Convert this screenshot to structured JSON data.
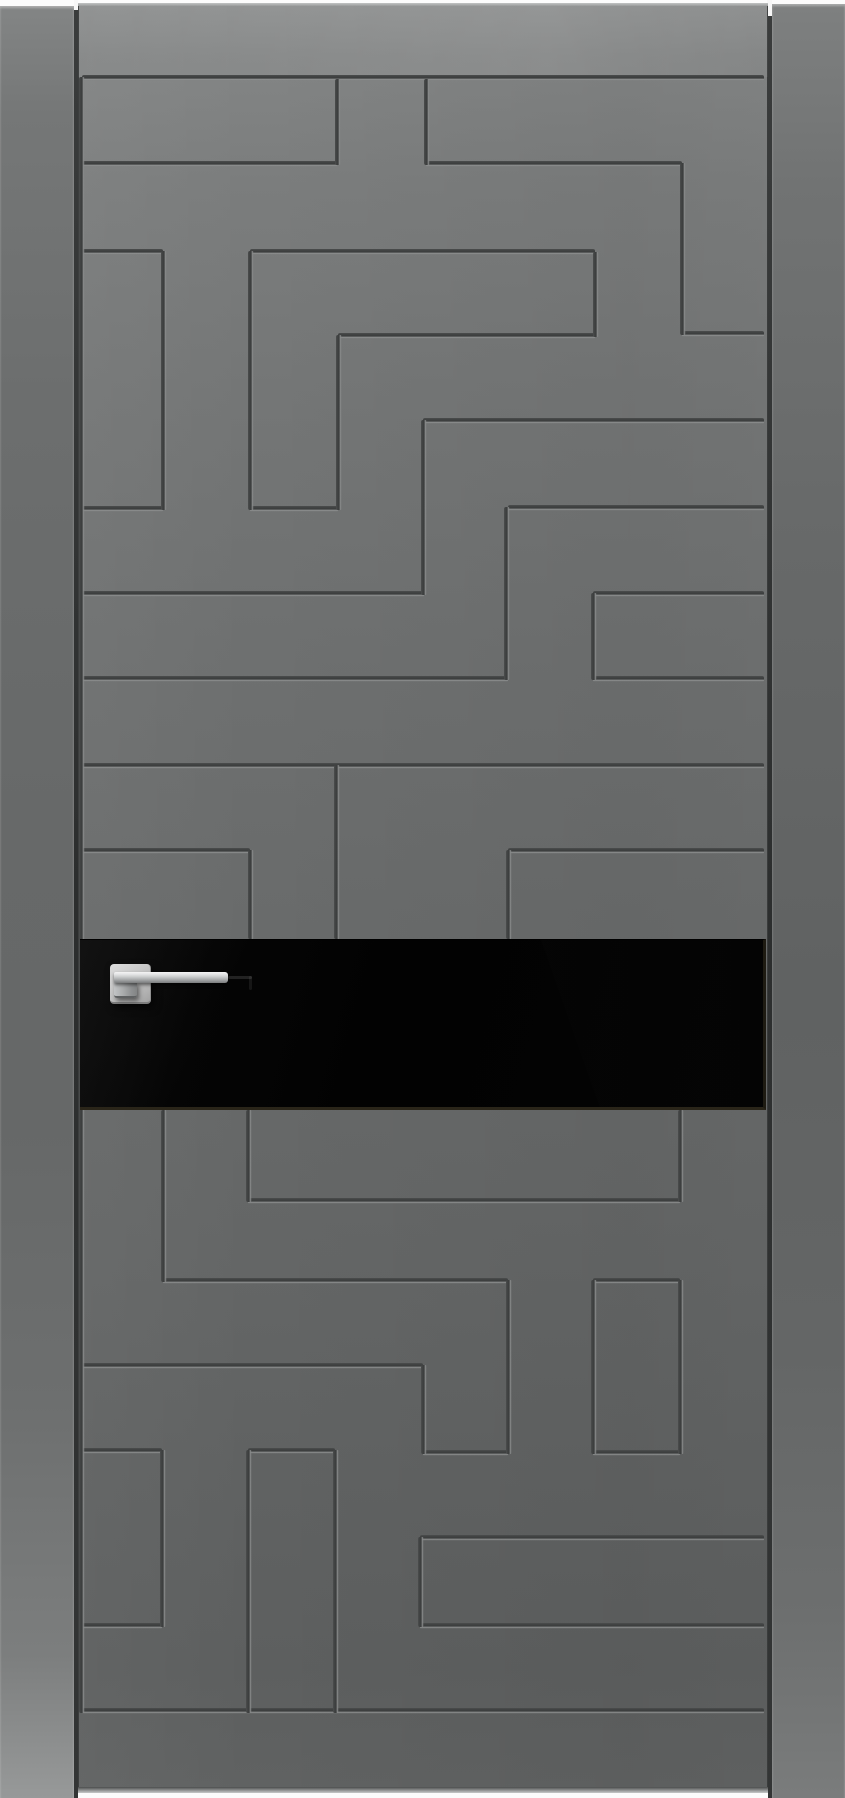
{
  "meta": {
    "description": "Product photograph of a modern grey interior door leaf with CNC-milled Greek-key maze pattern, horizontal black gloss glass insert and square-rosette chrome lever handle, shown between two frame jamb boards on a white background",
    "image_width": 845,
    "image_height": 1798
  },
  "palette": {
    "background": "#fcfcfc",
    "door_grey_light": "#8d8f8f",
    "door_grey_mid": "#6a6c6c",
    "door_grey_dark": "#5d5f5f",
    "groove_dark": "#3a3c3c",
    "groove_highlight": "#8f9191",
    "glass_black": "#020202",
    "glass_edge_tint": "#2a2519",
    "chrome_light": "#f4f4f4",
    "chrome_mid": "#c9cbcc",
    "chrome_dark": "#7b7d7e"
  },
  "door": {
    "frame": {
      "left_stile": {
        "x": 0,
        "y": 6,
        "w": 74,
        "h": 1792
      },
      "right_stile": {
        "x": 772,
        "y": 4,
        "w": 73,
        "h": 1794
      },
      "left_gap": {
        "x": 74,
        "y": 10,
        "w": 4,
        "h": 1788
      },
      "right_gap": {
        "x": 768,
        "y": 16,
        "w": 4,
        "h": 1782
      },
      "left_gap_notch": {
        "x": 74,
        "y": 0,
        "w": 4,
        "h": 10
      },
      "right_gap_notch": {
        "x": 767,
        "y": 0,
        "w": 5,
        "h": 16
      }
    },
    "slab": {
      "x": 78,
      "y": 3,
      "w": 690,
      "h": 1790
    },
    "edge_top": {
      "x": 78,
      "y": 3,
      "w": 690,
      "h": 3
    },
    "edge_bottom": {
      "x": 78,
      "y": 1787,
      "w": 690,
      "h": 6
    },
    "toprail": {
      "x": 78,
      "y": 3,
      "w": 690,
      "h": 74
    },
    "pattern": {
      "horizontal_grooves": [
        {
          "y": 77,
          "x1": 82,
          "x2": 764
        },
        {
          "y": 163,
          "x1": 82,
          "x2": 337
        },
        {
          "y": 163,
          "x1": 426,
          "x2": 682
        },
        {
          "y": 251,
          "x1": 82,
          "x2": 163
        },
        {
          "y": 251,
          "x1": 250,
          "x2": 595
        },
        {
          "y": 333,
          "x1": 682,
          "x2": 764
        },
        {
          "y": 335,
          "x1": 338,
          "x2": 595
        },
        {
          "y": 420,
          "x1": 423,
          "x2": 764
        },
        {
          "y": 508,
          "x1": 82,
          "x2": 163
        },
        {
          "y": 508,
          "x1": 250,
          "x2": 338
        },
        {
          "y": 507,
          "x1": 508,
          "x2": 764
        },
        {
          "y": 593,
          "x1": 82,
          "x2": 424
        },
        {
          "y": 593,
          "x1": 593,
          "x2": 764
        },
        {
          "y": 678,
          "x1": 82,
          "x2": 508
        },
        {
          "y": 678,
          "x1": 593,
          "x2": 764
        },
        {
          "y": 765,
          "x1": 82,
          "x2": 764
        },
        {
          "y": 850,
          "x1": 82,
          "x2": 250
        },
        {
          "y": 850,
          "x1": 508,
          "x2": 764
        },
        {
          "y": 1200,
          "x1": 248,
          "x2": 680
        },
        {
          "y": 1280,
          "x1": 163,
          "x2": 508
        },
        {
          "y": 1280,
          "x1": 593,
          "x2": 680
        },
        {
          "y": 1365,
          "x1": 82,
          "x2": 423
        },
        {
          "y": 1450,
          "x1": 82,
          "x2": 162
        },
        {
          "y": 1450,
          "x1": 248,
          "x2": 335
        },
        {
          "y": 1452,
          "x1": 423,
          "x2": 508
        },
        {
          "y": 1452,
          "x1": 593,
          "x2": 680
        },
        {
          "y": 1537,
          "x1": 420,
          "x2": 764
        },
        {
          "y": 1625,
          "x1": 82,
          "x2": 162
        },
        {
          "y": 1625,
          "x1": 420,
          "x2": 764
        },
        {
          "y": 1710,
          "x1": 82,
          "x2": 764
        }
      ],
      "vertical_grooves": [
        {
          "x": 81,
          "y1": 77,
          "y2": 1713
        },
        {
          "x": 337,
          "y1": 79,
          "y2": 165
        },
        {
          "x": 426,
          "y1": 79,
          "y2": 165
        },
        {
          "x": 682,
          "y1": 163,
          "y2": 335
        },
        {
          "x": 163,
          "y1": 251,
          "y2": 510
        },
        {
          "x": 250,
          "y1": 251,
          "y2": 510
        },
        {
          "x": 338,
          "y1": 335,
          "y2": 510
        },
        {
          "x": 595,
          "y1": 252,
          "y2": 337
        },
        {
          "x": 423,
          "y1": 420,
          "y2": 595
        },
        {
          "x": 506,
          "y1": 507,
          "y2": 680
        },
        {
          "x": 593,
          "y1": 593,
          "y2": 680
        },
        {
          "x": 250,
          "y1": 850,
          "y2": 939
        },
        {
          "x": 336,
          "y1": 765,
          "y2": 939
        },
        {
          "x": 508,
          "y1": 850,
          "y2": 939
        },
        {
          "x": 163,
          "y1": 1110,
          "y2": 1282
        },
        {
          "x": 248,
          "y1": 1110,
          "y2": 1202
        },
        {
          "x": 680,
          "y1": 1110,
          "y2": 1202
        },
        {
          "x": 508,
          "y1": 1280,
          "y2": 1454
        },
        {
          "x": 593,
          "y1": 1280,
          "y2": 1454
        },
        {
          "x": 680,
          "y1": 1280,
          "y2": 1454
        },
        {
          "x": 423,
          "y1": 1365,
          "y2": 1454
        },
        {
          "x": 162,
          "y1": 1450,
          "y2": 1627
        },
        {
          "x": 248,
          "y1": 1450,
          "y2": 1713
        },
        {
          "x": 335,
          "y1": 1450,
          "y2": 1713
        },
        {
          "x": 420,
          "y1": 1537,
          "y2": 1627
        }
      ]
    },
    "glass": {
      "x": 80,
      "y": 939,
      "w": 686,
      "h": 171,
      "reflection_top_x": 543,
      "reflection_bottom_x": 602
    },
    "handle": {
      "rosette": {
        "x": 110,
        "y": 964,
        "w": 41,
        "h": 40
      },
      "lever_bar": {
        "x": 114,
        "y": 972,
        "w": 114,
        "h": 11
      },
      "lever_neck": {
        "x": 114,
        "y": 982,
        "w": 23,
        "h": 16
      },
      "glass_shadow_h": {
        "x": 228,
        "y": 976,
        "w": 24,
        "h": 3
      },
      "glass_shadow_v": {
        "x": 249,
        "y": 976,
        "w": 3,
        "h": 14
      }
    }
  }
}
